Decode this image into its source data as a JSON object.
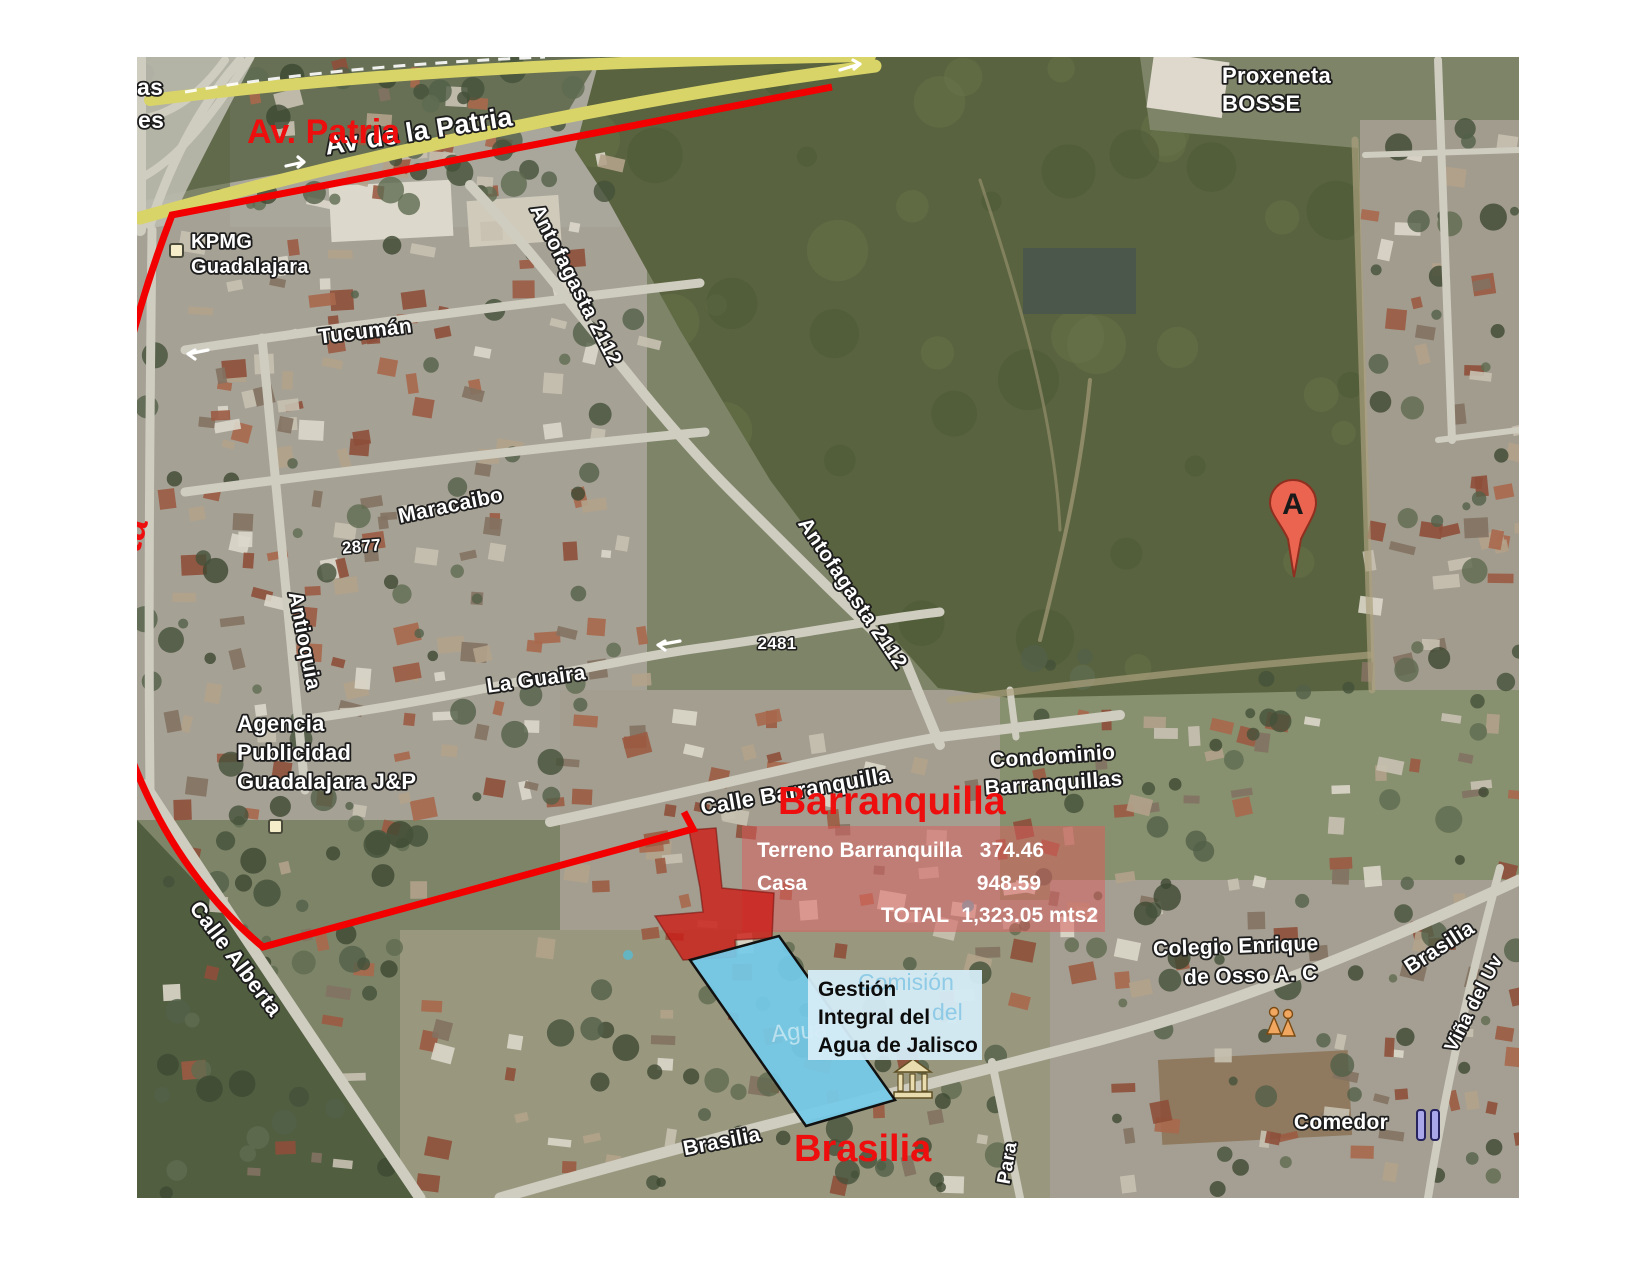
{
  "map_annotations": {
    "color": "#ee0e0e",
    "av_patria": "Av. Patria",
    "alberta": "Alberta",
    "barranquilla": "Barranquilla",
    "brasilia": "Brasilia"
  },
  "parcel_overlay": {
    "terreno_label": "Terreno Barranquilla",
    "terreno_value": "374.46",
    "casa_label": "Casa",
    "casa_value": "948.59",
    "total_label": "TOTAL",
    "total_value": "1,323.05 mts2"
  },
  "agency_label_box": {
    "line1": "Gestión",
    "line2": "Integral del",
    "line3": "Agua de Jalisco",
    "background": "#d5ecf7"
  },
  "map_watermarks": {
    "comision": "Comisión",
    "del": "del",
    "agua": "Agua"
  },
  "street_labels": {
    "edge_as": "as",
    "edge_es": "es",
    "patria": "Av de la Patria",
    "antofagasta1": "Antofagasta 2112",
    "tucuman": "Tucumán",
    "maracaibo": "Maracaibo",
    "num2877": "2877",
    "antioquia": "Antioquia",
    "la_guaira": "La Guaira",
    "num2481": "2481",
    "antofagasta2": "Antofagasta 2112",
    "calle_barranquilla": "Calle Barranquilla",
    "calle_alberta": "Calle Alberta",
    "brasilia_sw": "Brasilia",
    "brasilia_e": "Brasilia",
    "para": "Para",
    "vina": "Viña del Uv"
  },
  "poi_labels": {
    "kpmg_1": "KPMG",
    "kpmg_2": "Guadalajara",
    "agencia_1": "Agencia",
    "agencia_2": "Publicidad",
    "agencia_3": "Guadalajara J&P",
    "condominio_1": "Condominio",
    "condominio_2": "Barranquillas",
    "colegio_1": "Colegio Enrique",
    "colegio_2": "de Osso A. C",
    "comedor": "Comedor",
    "proxeneta_1": "Proxeneta",
    "proxeneta_2": "BOSSE"
  },
  "marker_a": {
    "letter": "A",
    "color": "#ea6450"
  },
  "parcel_colors": {
    "highlight_red": "#cc1e19",
    "overlay_pink": "rgba(222,92,92,0.5)",
    "parcel_blue": "#74cbea"
  }
}
